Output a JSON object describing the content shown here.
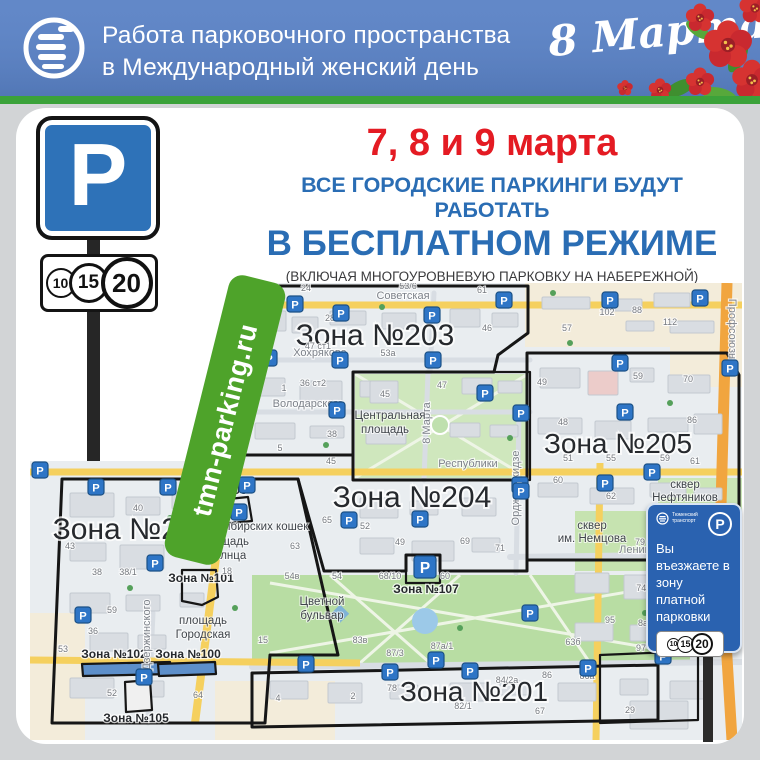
{
  "header": {
    "title_line1": "Работа парковочного пространства",
    "title_line2": "в Международный женский день",
    "holiday": "8 Марта!"
  },
  "announcement": {
    "dates": "7, 8 и 9 марта",
    "line1": "ВСЕ ГОРОДСКИЕ ПАРКИНГИ БУДУТ РАБОТАТЬ",
    "line2": "В БЕСПЛАТНОМ РЕЖИМЕ",
    "note": "(ВКЛЮЧАЯ МНОГОУРОВНЕВУЮ ПАРКОВКУ НА НАБЕРЕЖНОЙ)"
  },
  "parking_sign": {
    "letter": "P",
    "tariffs": [
      "10",
      "15",
      "20"
    ]
  },
  "site_label": "tmn-parking.ru",
  "entry_sign": {
    "operator": "Тюменский транспорт",
    "letter": "P",
    "text": "Вы въезжаете в зону платной парковки",
    "tariffs": [
      "10",
      "15",
      "20"
    ]
  },
  "colors": {
    "header_bg": "#5b80c0",
    "strip_green": "#3ba23a",
    "date_red": "#e41b23",
    "title_blue": "#2a6db4",
    "sign_blue": "#2e72b8",
    "marker_blue": "#2e75c6",
    "site_green": "#4ea32a",
    "entry_sign_blue": "#2a62b0"
  },
  "map": {
    "zones": [
      {
        "label": "Зона №203",
        "outline": "212,3 498,3 498,50 468,72 464,89 323,89 323,172 182,172",
        "x": 345,
        "y": 62,
        "font": 30
      },
      {
        "label": "Зона №205",
        "outline": "497,70 697,70 709,92 709,277 497,277",
        "x": 588,
        "y": 170,
        "font": 28
      },
      {
        "label": "Зона №204",
        "outline": "182,172 323,172 323,197 497,197 497,288 410,288 410,272 376,272 376,288 294,288 268,196 182,196",
        "x": 382,
        "y": 224,
        "font": 30
      },
      {
        "label": "Зона №202",
        "outline": "32,196 268,196 308,372 240,372 235,440 22,440",
        "x": 102,
        "y": 256,
        "font": 30
      },
      {
        "label": "Зона №201",
        "outline": "222,390 628,382 628,437 222,444",
        "x": 444,
        "y": 418,
        "font": 28
      },
      {
        "label": "",
        "outline": "323,89 500,89 500,197 323,197",
        "x": 0,
        "y": 0,
        "font": 12
      },
      {
        "label": "",
        "outline": "570,372 668,368 668,437 570,440",
        "x": 0,
        "y": 0,
        "font": 12
      },
      {
        "label": "Зона №106",
        "outline": "188,217 218,214 222,238 190,241",
        "x": 184,
        "y": 211,
        "font": 12
      },
      {
        "label": "Зона №101",
        "outline": "152,287 186,287 188,314 172,322 152,318",
        "x": 171,
        "y": 299,
        "font": 12
      },
      {
        "label": "Зона №102",
        "outline": "52,381 140,379 141,391 53,393",
        "fill": "#5d8fca",
        "x": 84,
        "y": 375,
        "font": 12
      },
      {
        "label": "Зона №100",
        "outline": "128,381 185,379 186,391 129,393",
        "fill": "#5d8fca",
        "x": 158,
        "y": 375,
        "font": 12
      },
      {
        "label": "Зона №105",
        "outline": "95,399 120,397 122,427 96,429",
        "fill": "#f0f0f0",
        "x": 106,
        "y": 439,
        "font": 12
      },
      {
        "label": "Зона №107",
        "outline": "376,272 410,272 410,300 376,300",
        "x": 396,
        "y": 310,
        "font": 12
      }
    ],
    "streets": [
      {
        "name": "Советская",
        "x": 373,
        "y": 16,
        "rot": 0
      },
      {
        "name": "Хохрякова",
        "x": 290,
        "y": 73,
        "rot": 0
      },
      {
        "name": "Володарского",
        "x": 278,
        "y": 124,
        "rot": 0
      },
      {
        "name": "Республики",
        "x": 438,
        "y": 184,
        "rot": 0
      },
      {
        "name": "Ленина",
        "x": 608,
        "y": 270,
        "rot": 0
      },
      {
        "name": "8 Марта",
        "x": 400,
        "y": 140,
        "rot": -90
      },
      {
        "name": "Орджоникидзе",
        "x": 489,
        "y": 205,
        "rot": -90
      },
      {
        "name": "Дзержинского",
        "x": 120,
        "y": 352,
        "rot": -90
      },
      {
        "name": "Профсоюзная",
        "x": 699,
        "y": 52,
        "rot": 90
      }
    ],
    "places": [
      {
        "name": "Центральная",
        "x": 360,
        "y": 136
      },
      {
        "name": "площадь",
        "x": 355,
        "y": 150
      },
      {
        "name": "Цветной",
        "x": 292,
        "y": 322
      },
      {
        "name": "бульвар",
        "x": 292,
        "y": 336
      },
      {
        "name": "сквер",
        "x": 562,
        "y": 246
      },
      {
        "name": "им. Немцова",
        "x": 562,
        "y": 259
      },
      {
        "name": "сквер",
        "x": 655,
        "y": 205
      },
      {
        "name": "Нефтяников",
        "x": 655,
        "y": 218
      },
      {
        "name": "площадь",
        "x": 195,
        "y": 262
      },
      {
        "name": "Солнца",
        "x": 196,
        "y": 276
      },
      {
        "name": "Сибирских кошек",
        "x": 232,
        "y": 247
      },
      {
        "name": "площадь",
        "x": 173,
        "y": 341
      },
      {
        "name": "Городская",
        "x": 173,
        "y": 355
      }
    ],
    "houses": [
      [
        "24",
        276,
        8
      ],
      [
        "53/6",
        378,
        6
      ],
      [
        "61",
        452,
        10
      ],
      [
        "28",
        300,
        38
      ],
      [
        "47 ст1",
        288,
        66
      ],
      [
        "53а",
        358,
        73
      ],
      [
        "102",
        577,
        32
      ],
      [
        "88",
        607,
        30
      ],
      [
        "112",
        640,
        42
      ],
      [
        "57",
        537,
        48
      ],
      [
        "46",
        457,
        48
      ],
      [
        "36 ст2",
        283,
        103
      ],
      [
        "1",
        254,
        108
      ],
      [
        "59",
        608,
        96
      ],
      [
        "49",
        512,
        102
      ],
      [
        "70",
        658,
        99
      ],
      [
        "38",
        302,
        154
      ],
      [
        "45",
        301,
        181
      ],
      [
        "5",
        250,
        168
      ],
      [
        "45",
        355,
        114
      ],
      [
        "47",
        412,
        105
      ],
      [
        "48",
        533,
        142
      ],
      [
        "86",
        662,
        140
      ],
      [
        "51",
        538,
        178
      ],
      [
        "55",
        581,
        178
      ],
      [
        "59",
        635,
        178
      ],
      [
        "61",
        665,
        181
      ],
      [
        "40",
        108,
        228
      ],
      [
        "57",
        152,
        262
      ],
      [
        "43",
        40,
        266
      ],
      [
        "38",
        67,
        292
      ],
      [
        "38/1",
        98,
        292
      ],
      [
        "63",
        265,
        266
      ],
      [
        "18",
        197,
        291
      ],
      [
        "59",
        82,
        330
      ],
      [
        "54в",
        262,
        296
      ],
      [
        "54",
        307,
        296
      ],
      [
        "68/10",
        360,
        296
      ],
      [
        "60",
        415,
        296
      ],
      [
        "65",
        297,
        240
      ],
      [
        "52",
        335,
        246
      ],
      [
        "49",
        370,
        262
      ],
      [
        "69",
        435,
        261
      ],
      [
        "71",
        470,
        268
      ],
      [
        "60",
        528,
        200
      ],
      [
        "62",
        581,
        216
      ],
      [
        "79",
        610,
        262
      ],
      [
        "74 к1",
        617,
        308
      ],
      [
        "95",
        580,
        340
      ],
      [
        "8а",
        613,
        343
      ],
      [
        "63б",
        543,
        362
      ],
      [
        "97",
        611,
        368
      ],
      [
        "36",
        63,
        351
      ],
      [
        "53",
        33,
        369
      ],
      [
        "52",
        82,
        413
      ],
      [
        "64",
        168,
        415
      ],
      [
        "15",
        233,
        360
      ],
      [
        "4",
        248,
        418
      ],
      [
        "83в",
        330,
        360
      ],
      [
        "87/3",
        365,
        373
      ],
      [
        "87а/1",
        412,
        366
      ],
      [
        "78",
        362,
        408
      ],
      [
        "2",
        323,
        416
      ],
      [
        "82/1",
        433,
        426
      ],
      [
        "84/2а",
        477,
        400
      ],
      [
        "86",
        517,
        395
      ],
      [
        "86а",
        557,
        396
      ],
      [
        "67",
        510,
        431
      ],
      [
        "29",
        600,
        430
      ]
    ],
    "markers": [
      [
        265,
        21
      ],
      [
        311,
        30
      ],
      [
        402,
        32
      ],
      [
        474,
        17
      ],
      [
        580,
        17
      ],
      [
        670,
        15
      ],
      [
        239,
        75
      ],
      [
        310,
        77
      ],
      [
        403,
        77
      ],
      [
        590,
        80
      ],
      [
        700,
        85
      ],
      [
        307,
        127
      ],
      [
        455,
        110
      ],
      [
        10,
        187
      ],
      [
        66,
        204
      ],
      [
        138,
        204
      ],
      [
        217,
        202
      ],
      [
        209,
        229
      ],
      [
        125,
        280
      ],
      [
        53,
        332
      ],
      [
        319,
        237
      ],
      [
        390,
        236
      ],
      [
        490,
        202
      ],
      [
        500,
        330
      ],
      [
        595,
        129
      ],
      [
        622,
        189
      ],
      [
        575,
        200
      ],
      [
        491,
        130
      ],
      [
        491,
        208
      ],
      [
        276,
        381
      ],
      [
        360,
        389
      ],
      [
        406,
        377
      ],
      [
        440,
        388
      ],
      [
        558,
        385
      ],
      [
        633,
        373
      ],
      [
        114,
        394
      ],
      [
        395,
        284,
        22
      ]
    ]
  }
}
